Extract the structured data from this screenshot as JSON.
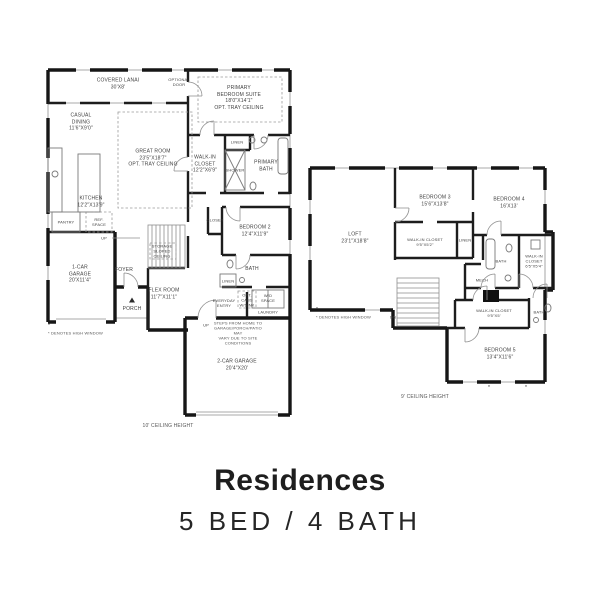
{
  "title": "Residences",
  "subtitle": "5 BED / 4 BATH",
  "window_marker": "*",
  "floor1": {
    "ceiling_note": "10' CEILING HEIGHT",
    "window_note": "* DENOTES HIGH WINDOW",
    "labels": {
      "covered_lanai": "COVERED LANAI\n30'X8'",
      "optional_door": "OPTIONAL\nDOOR",
      "casual_dining": "CASUAL\nDINING\n11'6\"X9'0\"",
      "great_room": "GREAT ROOM\n23'5\"X18'7\"\nOPT. TRAY CEILING",
      "primary_suite": "PRIMARY\nBEDROOM SUITE\n18'0\"X14'1\"\nOPT. TRAY CEILING",
      "linen": "LINEN",
      "walk_in_closet": "WALK-IN\nCLOSET\n12'2\"X6'9\"",
      "shower": "SHOWER",
      "primary_bath": "PRIMARY\nBATH",
      "closet": "CLOSET",
      "bedroom2": "BEDROOM 2\n12'4\"X11'9\"",
      "kitchen": "KITCHEN\n12'2\"X13'9\"",
      "pantry": "PANTRY",
      "ref_space": "REF.\nSPACE",
      "one_car_garage": "1-CAR\nGARAGE\n20'X11'4\"",
      "foyer": "FOYER",
      "up_stairs": "UP",
      "storage": "STORAGE\nSLOPED\nCEILING",
      "flex_room": "FLEX ROOM\n11'7\"X11'1\"",
      "porch": "PORCH",
      "bath": "BATH",
      "linen2": "LINEN",
      "everyday_entry": "EVERYDAY\nENTRY",
      "opt_cabs": "OPT.\nCABS\nW/SINK",
      "wd_space": "W/D\nSPACE",
      "laundry": "LAUNDRY",
      "up_garage": "UP",
      "steps_note": "STEPS FROM HOME TO\nGARAGE/PORCH/PATIO MAY\nVARY DUE TO SITE CONDITIONS",
      "two_car_garage": "2-CAR GARAGE\n20'4\"X20'"
    }
  },
  "floor2": {
    "ceiling_note": "9' CEILING HEIGHT",
    "window_note": "* DENOTES HIGH WINDOW",
    "labels": {
      "loft": "LOFT\n23'1\"X18'8\"",
      "bedroom3": "BEDROOM 3\n15'6\"X13'8\"",
      "bedroom4": "BEDROOM 4\n16'X13'",
      "wic_bedroom3": "WALK-IN CLOSET\n9'5\"X5'2\"",
      "linen": "LINEN",
      "bath2": "BATH",
      "wic_bedroom4": "WALK-IN\nCLOSET\n6'5\"X5'4\"",
      "mech": "MECH",
      "wic_bedroom5": "WALK-IN CLOSET\n9'5\"X5'",
      "bath3": "BATH",
      "bedroom5": "BEDROOM 5\n13'4\"X11'6\"",
      "dn": "DN"
    }
  }
}
